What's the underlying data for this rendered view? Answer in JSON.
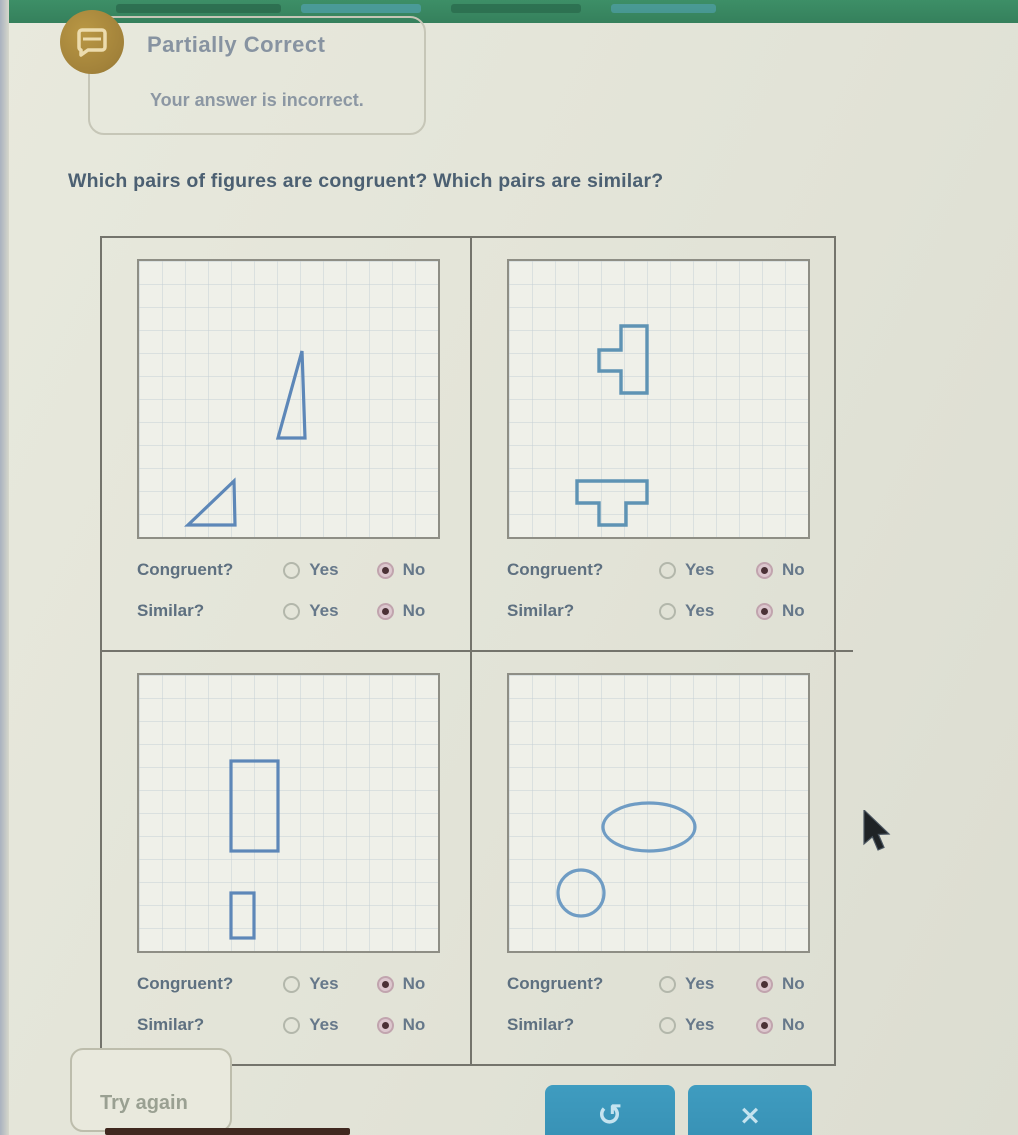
{
  "feedback": {
    "title": "Partially Correct",
    "message": "Your answer is incorrect."
  },
  "question": "Which pairs of figures are congruent? Which pairs are similar?",
  "panels": [
    {
      "name": "triangles",
      "figures": [
        "tall narrow right triangle",
        "small right triangle"
      ],
      "congruent_label": "Congruent?",
      "similar_label": "Similar?",
      "yes": "Yes",
      "no": "No",
      "congruent_answer": "No",
      "similar_answer": "No"
    },
    {
      "name": "t-shapes",
      "figures": [
        "T-tetromino rotated left",
        "T-tetromino pointing down"
      ],
      "congruent_label": "Congruent?",
      "similar_label": "Similar?",
      "yes": "Yes",
      "no": "No",
      "congruent_answer": "No",
      "similar_answer": "No"
    },
    {
      "name": "rectangles",
      "figures": [
        "large vertical rectangle",
        "small vertical rectangle"
      ],
      "congruent_label": "Congruent?",
      "similar_label": "Similar?",
      "yes": "Yes",
      "no": "No",
      "congruent_answer": "No",
      "similar_answer": "No"
    },
    {
      "name": "ellipses",
      "figures": [
        "wide ellipse",
        "small circle"
      ],
      "congruent_label": "Congruent?",
      "similar_label": "Similar?",
      "yes": "Yes",
      "no": "No",
      "congruent_answer": "No",
      "similar_answer": "No"
    }
  ],
  "footer": {
    "try_again": "Try again",
    "undo_symbol": "↺",
    "close_symbol": "×"
  },
  "colors": {
    "header_green": "#3a8a63",
    "page_background": "#e2e3d7",
    "blue_button": "#3793b8",
    "shape_stroke": "#5d87b8",
    "selected_dot": "#4b3136",
    "badge_gold": "#a2823a"
  }
}
